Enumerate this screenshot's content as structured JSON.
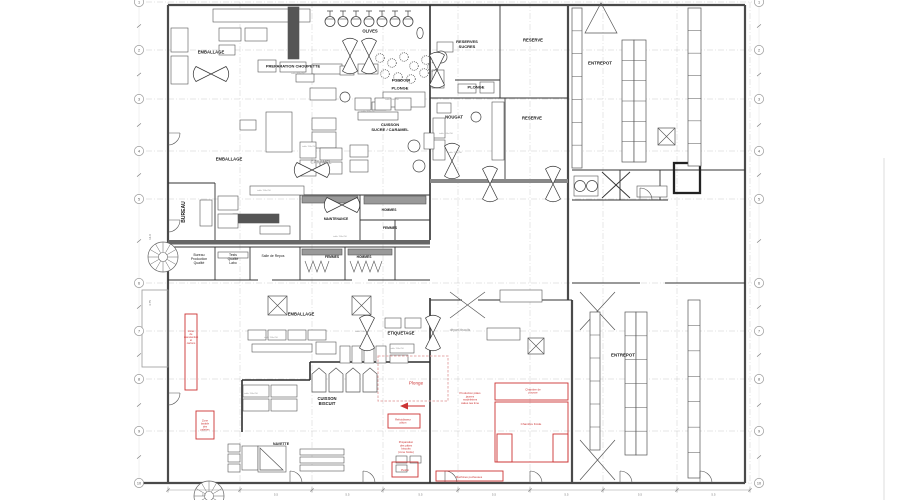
{
  "colors": {
    "wall": "#4a4a4a",
    "wall_dark": "#2e2e2e",
    "line": "#555555",
    "red": "#cc3333",
    "pink": "#e5a8a8",
    "grid": "#c9c9c9",
    "gray_text": "#8a8a8a",
    "dim_text": "#777777",
    "bubble_stroke": "#999999",
    "bubble_text": "#555555"
  },
  "grid": {
    "left_column_x": 139,
    "right_column_x": 759,
    "rows": [
      {
        "label": "1",
        "y": 2
      },
      {
        "label": "2",
        "y": 50
      },
      {
        "label": "3",
        "y": 99
      },
      {
        "label": "4",
        "y": 151
      },
      {
        "label": "5",
        "y": 199
      },
      {
        "label": "6",
        "y": 283
      },
      {
        "label": "7",
        "y": 331
      },
      {
        "label": "8",
        "y": 379
      },
      {
        "label": "9",
        "y": 431
      },
      {
        "label": "10",
        "y": 483
      }
    ],
    "left_dims": [
      {
        "text": "14.0",
        "x": 151,
        "y": 237
      },
      {
        "text": "4.75",
        "x": 151,
        "y": 303
      }
    ],
    "bottom_dims": {
      "y": 490,
      "ticks_x": [
        168,
        240,
        312,
        383,
        458,
        530,
        603,
        677,
        750
      ],
      "bay_label": "5.5"
    }
  },
  "room_labels": [
    {
      "t": "EMBALLAGE",
      "x": 211,
      "y": 52,
      "s": 4.2,
      "b": 1
    },
    {
      "t": "PREPARATION CHOUPETTE",
      "x": 293,
      "y": 66,
      "s": 4,
      "b": 1
    },
    {
      "t": "OLIVES",
      "x": 370,
      "y": 31,
      "s": 4.2,
      "b": 1
    },
    {
      "t": "RESERVES\nSUCRES",
      "x": 467,
      "y": 44,
      "s": 4,
      "b": 1
    },
    {
      "t": "RESERVE",
      "x": 533,
      "y": 40,
      "s": 4.2,
      "b": 1
    },
    {
      "t": "ENTREPOT",
      "x": 600,
      "y": 63,
      "s": 4.4,
      "b": 1
    },
    {
      "t": "FONDOIR",
      "x": 401,
      "y": 80,
      "s": 4,
      "b": 1
    },
    {
      "t": "PLONGE",
      "x": 400,
      "y": 88,
      "s": 4,
      "b": 1
    },
    {
      "t": "PLONGE",
      "x": 476,
      "y": 87,
      "s": 4,
      "b": 1
    },
    {
      "t": "NOUGAT",
      "x": 454,
      "y": 117,
      "s": 4.2,
      "b": 1
    },
    {
      "t": "RESERVE",
      "x": 532,
      "y": 118,
      "s": 4.2,
      "b": 1
    },
    {
      "t": "CUISSON\nSUCRE / CARAMEL",
      "x": 390,
      "y": 127,
      "s": 4,
      "b": 1
    },
    {
      "t": "EMBALLAGE",
      "x": 229,
      "y": 159,
      "s": 4.2,
      "b": 1
    },
    {
      "t": "CARAMEL",
      "x": 321,
      "y": 162,
      "s": 4.2,
      "b": 1,
      "c": "#9a9a9a"
    },
    {
      "t": "BUREAU",
      "x": 183,
      "y": 212,
      "s": 5,
      "b": 1,
      "r": -90
    },
    {
      "t": "MAINTENANCE",
      "x": 336,
      "y": 219,
      "s": 3.3,
      "b": 1
    },
    {
      "t": "HOMMES",
      "x": 389,
      "y": 210,
      "s": 3.3,
      "b": 1
    },
    {
      "t": "FEMMES",
      "x": 390,
      "y": 228,
      "s": 3.3,
      "b": 1
    },
    {
      "t": "FEMMES",
      "x": 332,
      "y": 257,
      "s": 3.3,
      "b": 1
    },
    {
      "t": "HOMMES",
      "x": 364,
      "y": 257,
      "s": 3.3,
      "b": 1
    },
    {
      "t": "Bureau\nProduction\nQualité",
      "x": 199,
      "y": 259,
      "s": 3.4
    },
    {
      "t": "Tests\nQualité\nLabo",
      "x": 233,
      "y": 259,
      "s": 3.4
    },
    {
      "t": "Salle de Repos",
      "x": 273,
      "y": 256,
      "s": 3.4
    },
    {
      "t": "EMBALLAGE",
      "x": 301,
      "y": 314,
      "s": 4.2,
      "b": 1
    },
    {
      "t": "ETIQUETAGE",
      "x": 401,
      "y": 333,
      "s": 4.2,
      "b": 1
    },
    {
      "t": "départ biscuits",
      "x": 460,
      "y": 330,
      "s": 3.2,
      "c": "#8a8a8a"
    },
    {
      "t": "CUISSON\nBISCUIT",
      "x": 327,
      "y": 401,
      "s": 4.2,
      "b": 1
    },
    {
      "t": "NAVETTE",
      "x": 281,
      "y": 444,
      "s": 3.5,
      "b": 1
    },
    {
      "t": "ENTREPOT",
      "x": 623,
      "y": 355,
      "s": 4.4,
      "b": 1
    }
  ],
  "red_labels": [
    {
      "t": "Zone\nde\nmanutention\net\ncartons",
      "x": 191,
      "y": 337,
      "s": 2.6
    },
    {
      "t": "Zone\nlavable\ndes\npalettes",
      "x": 205,
      "y": 425,
      "s": 2.6
    },
    {
      "t": "Plonge",
      "x": 416,
      "y": 383,
      "s": 4.6
    },
    {
      "t": "Production pâtes\njaunes\nmadeleines\ncakes tea time",
      "x": 470,
      "y": 398,
      "s": 2.8
    },
    {
      "t": "Chambre de\npousse",
      "x": 533,
      "y": 391,
      "s": 2.8
    },
    {
      "t": "Chambre froide",
      "x": 531,
      "y": 424,
      "s": 3
    },
    {
      "t": "Refroidisseur\npâton",
      "x": 403,
      "y": 421,
      "s": 2.7
    },
    {
      "t": "Préparation\ndes pâtes\nbiscuits\n(zone froide)",
      "x": 406,
      "y": 447,
      "s": 2.8
    },
    {
      "t": "Pétrin",
      "x": 405,
      "y": 470,
      "s": 3
    },
    {
      "t": "Machines pocheuses",
      "x": 469,
      "y": 477,
      "s": 2.8
    }
  ],
  "equipment_labels": [
    {
      "t": "table 700x700",
      "x": 392,
      "y": 99
    },
    {
      "t": "table 700x700",
      "x": 368,
      "y": 111
    },
    {
      "t": "table 700x700",
      "x": 309,
      "y": 146
    },
    {
      "t": "table 700x700",
      "x": 264,
      "y": 190
    },
    {
      "t": "table 700x700",
      "x": 446,
      "y": 133
    },
    {
      "t": "table 700x700",
      "x": 362,
      "y": 331
    },
    {
      "t": "table 700x700",
      "x": 271,
      "y": 337
    },
    {
      "t": "table 700x700",
      "x": 251,
      "y": 393
    },
    {
      "t": "table 700x700",
      "x": 397,
      "y": 348
    },
    {
      "t": "table 700x700",
      "x": 340,
      "y": 236
    },
    {
      "t": "table 700x700",
      "x": 455,
      "y": 152
    },
    {
      "t": "table 700x700",
      "x": 298,
      "y": 73
    }
  ]
}
